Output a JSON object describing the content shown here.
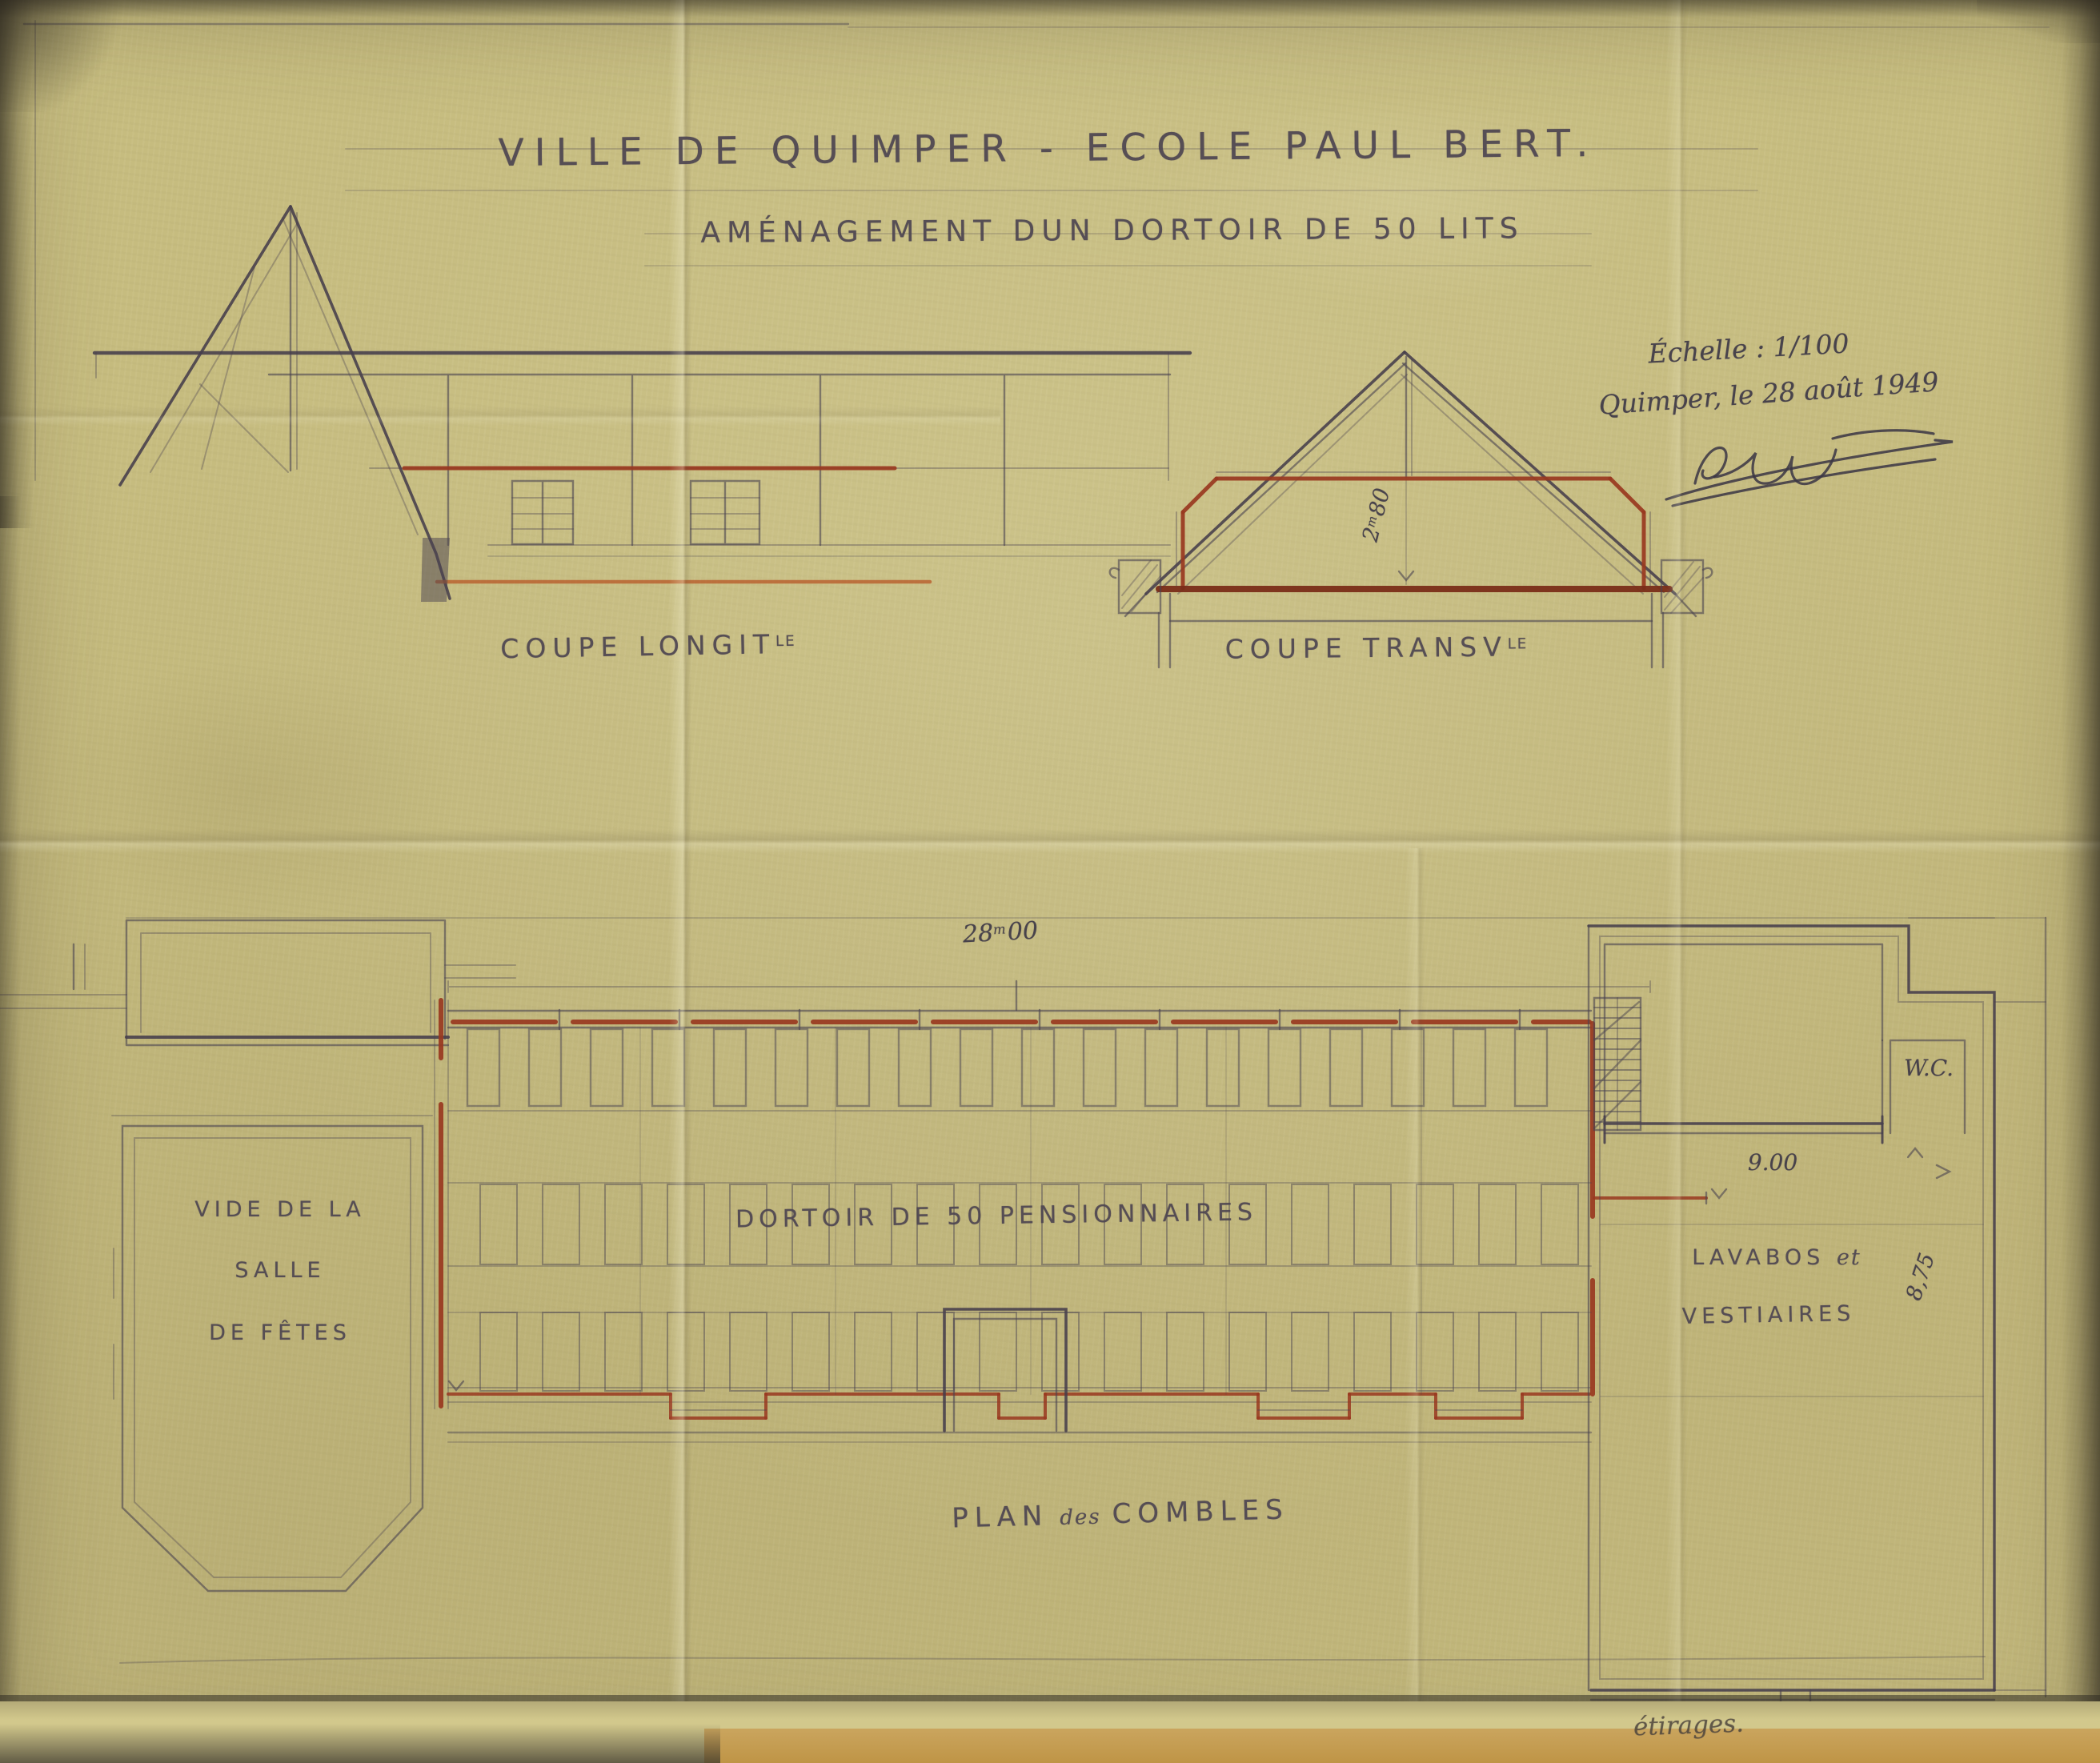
{
  "document": {
    "title": "VILLE DE QUIMPER - ECOLE PAUL BERT.",
    "subtitle": "AMÉNAGEMENT DUN DORTOIR DE 50 LITS",
    "scale_note": "Échelle : 1/100",
    "place_date": "Quimper, le 28 août 1949",
    "handwritten_note": "étirages."
  },
  "sections": {
    "longitudinal_label": "COUPE LONGIT",
    "longitudinal_label_sup": "LE",
    "transverse_label": "COUPE TRANSV",
    "transverse_label_sup": "LE",
    "transverse_height": {
      "whole": "2",
      "unit": "m",
      "frac": "80"
    }
  },
  "plan": {
    "label_main": "PLAN",
    "label_small": "des",
    "label_main2": "COMBLES",
    "length": {
      "whole": "28",
      "unit": "m",
      "frac": "00"
    },
    "hall_void_line1": "VIDE DE LA",
    "hall_void_line2": "SALLE",
    "hall_void_line3": "DE FÊTES",
    "dormitory_label": "DORTOIR DE 50 PENSIONNAIRES",
    "wc_label": "W.C.",
    "annex_width": "9.00",
    "annex_depth": "8,75",
    "washroom_line1_main": "LAVABOS",
    "washroom_line1_small": "et",
    "washroom_line2": "VESTIAIRES"
  },
  "colors": {
    "paper": "#c6bc7f",
    "graphite": "#4a4250",
    "red_ink": "#993820",
    "orange_ink": "#b85c2b"
  }
}
